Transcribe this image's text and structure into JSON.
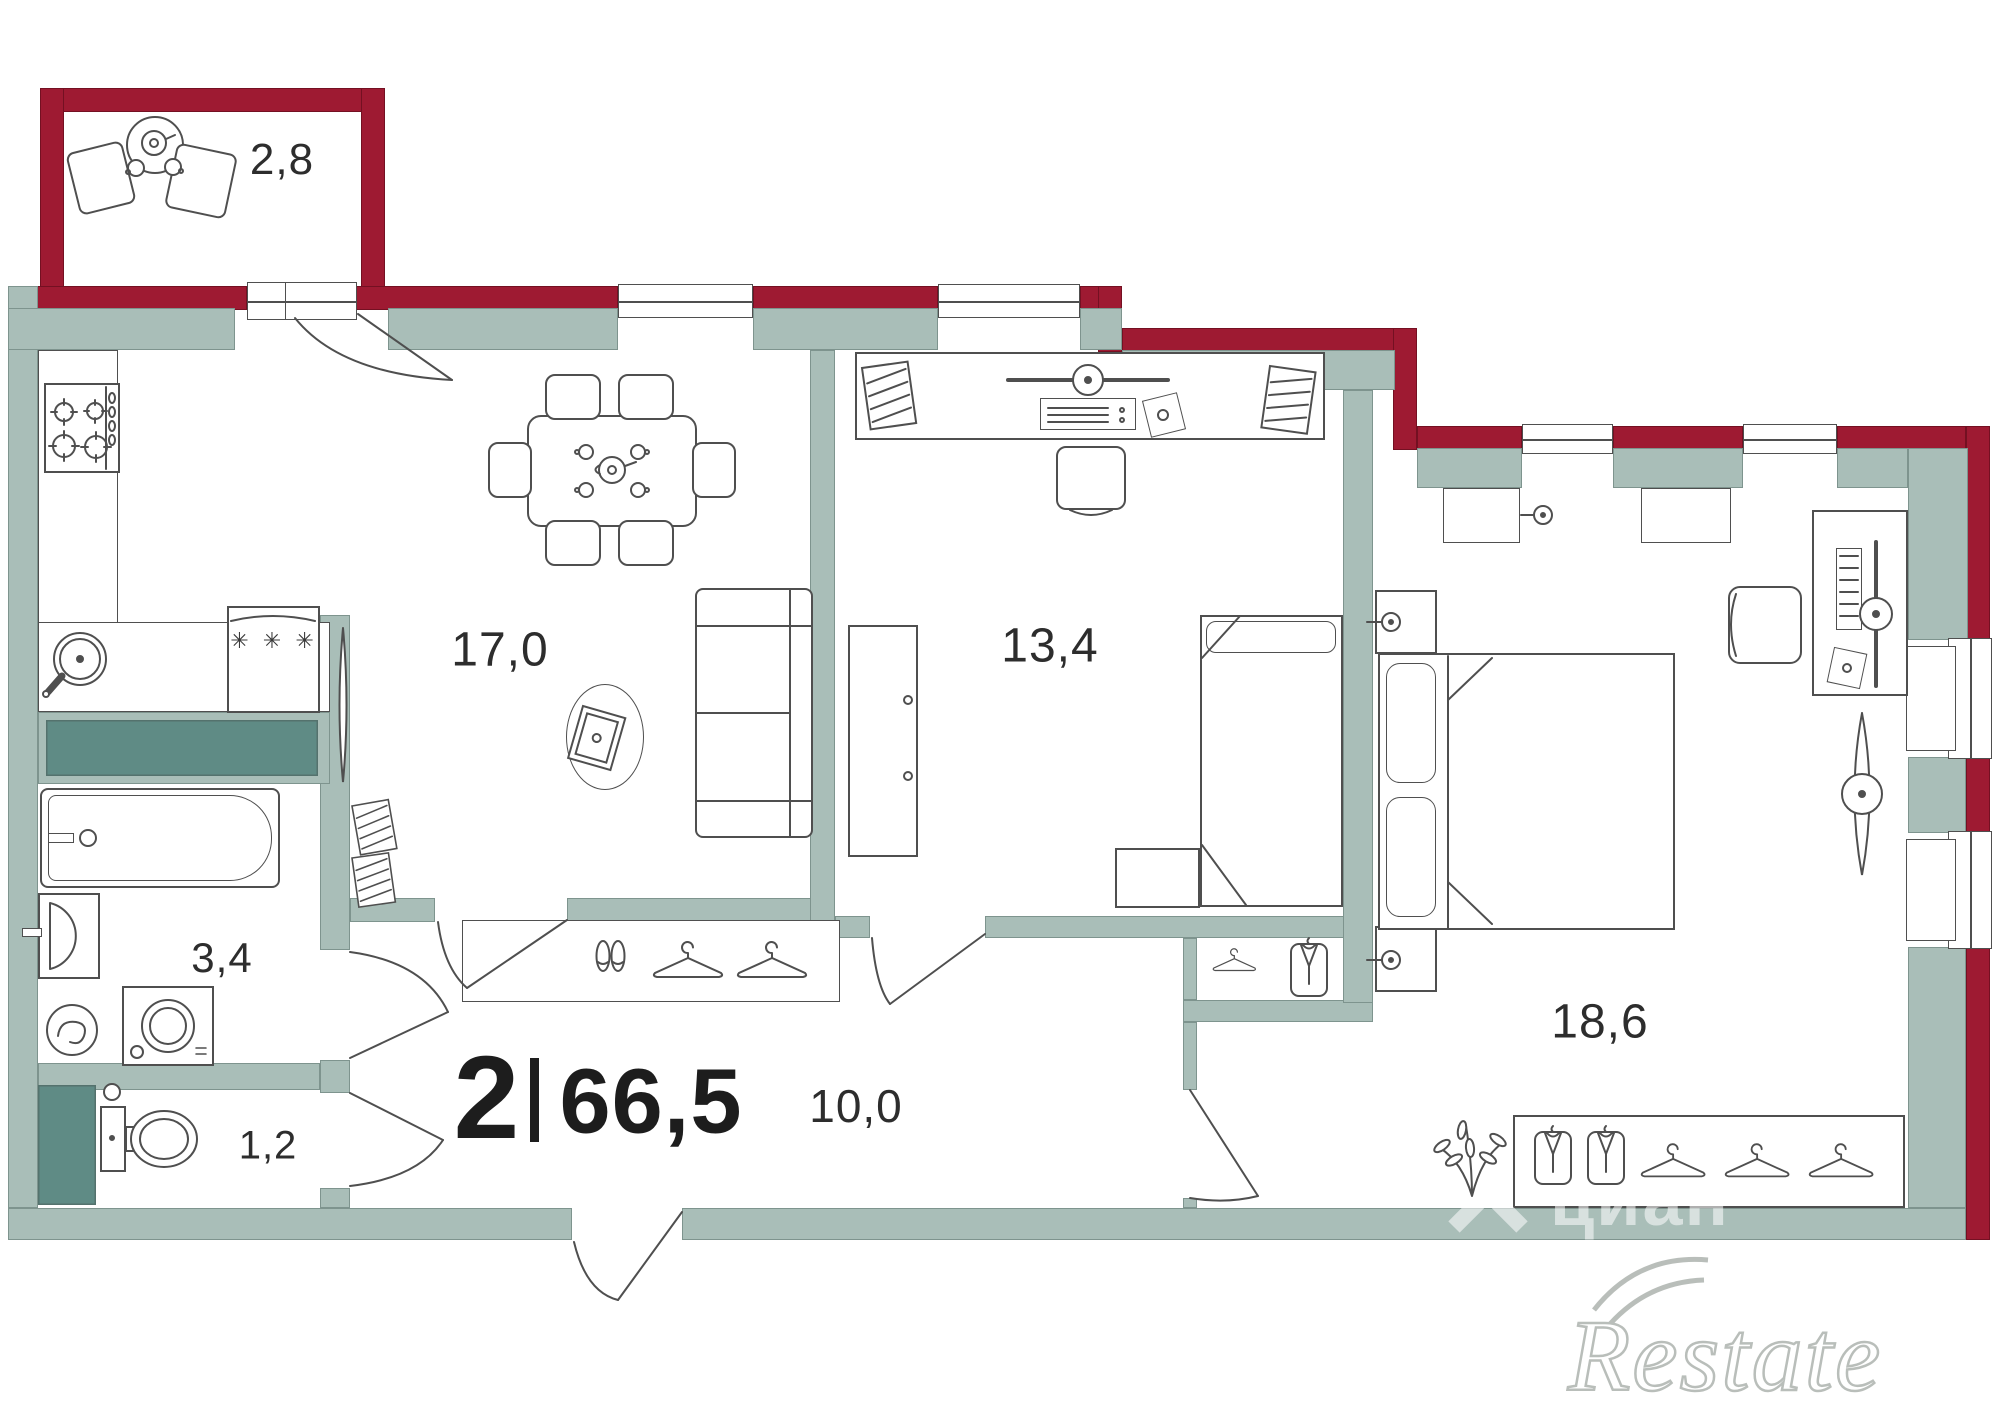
{
  "summary": {
    "rooms_count": "2",
    "separator": "|",
    "total_area": "66,5"
  },
  "room_labels": {
    "balcony": "2,8",
    "living_kitchen": "17,0",
    "room": "13,4",
    "bedroom": "18,6",
    "bathroom": "3,4",
    "wc": "1,2",
    "hall": "10,0"
  },
  "symbols": {
    "fridge_stars": "✳ ✳ ✳"
  },
  "watermarks": {
    "cian": "циан",
    "restate": "Restate"
  },
  "colors": {
    "exterior_wall": "#9e1a32",
    "interior_wall": "#a9beb8",
    "shaft": "#5f8b85",
    "furniture_line": "#4f4f4f",
    "label_text": "#2d2d2d"
  }
}
